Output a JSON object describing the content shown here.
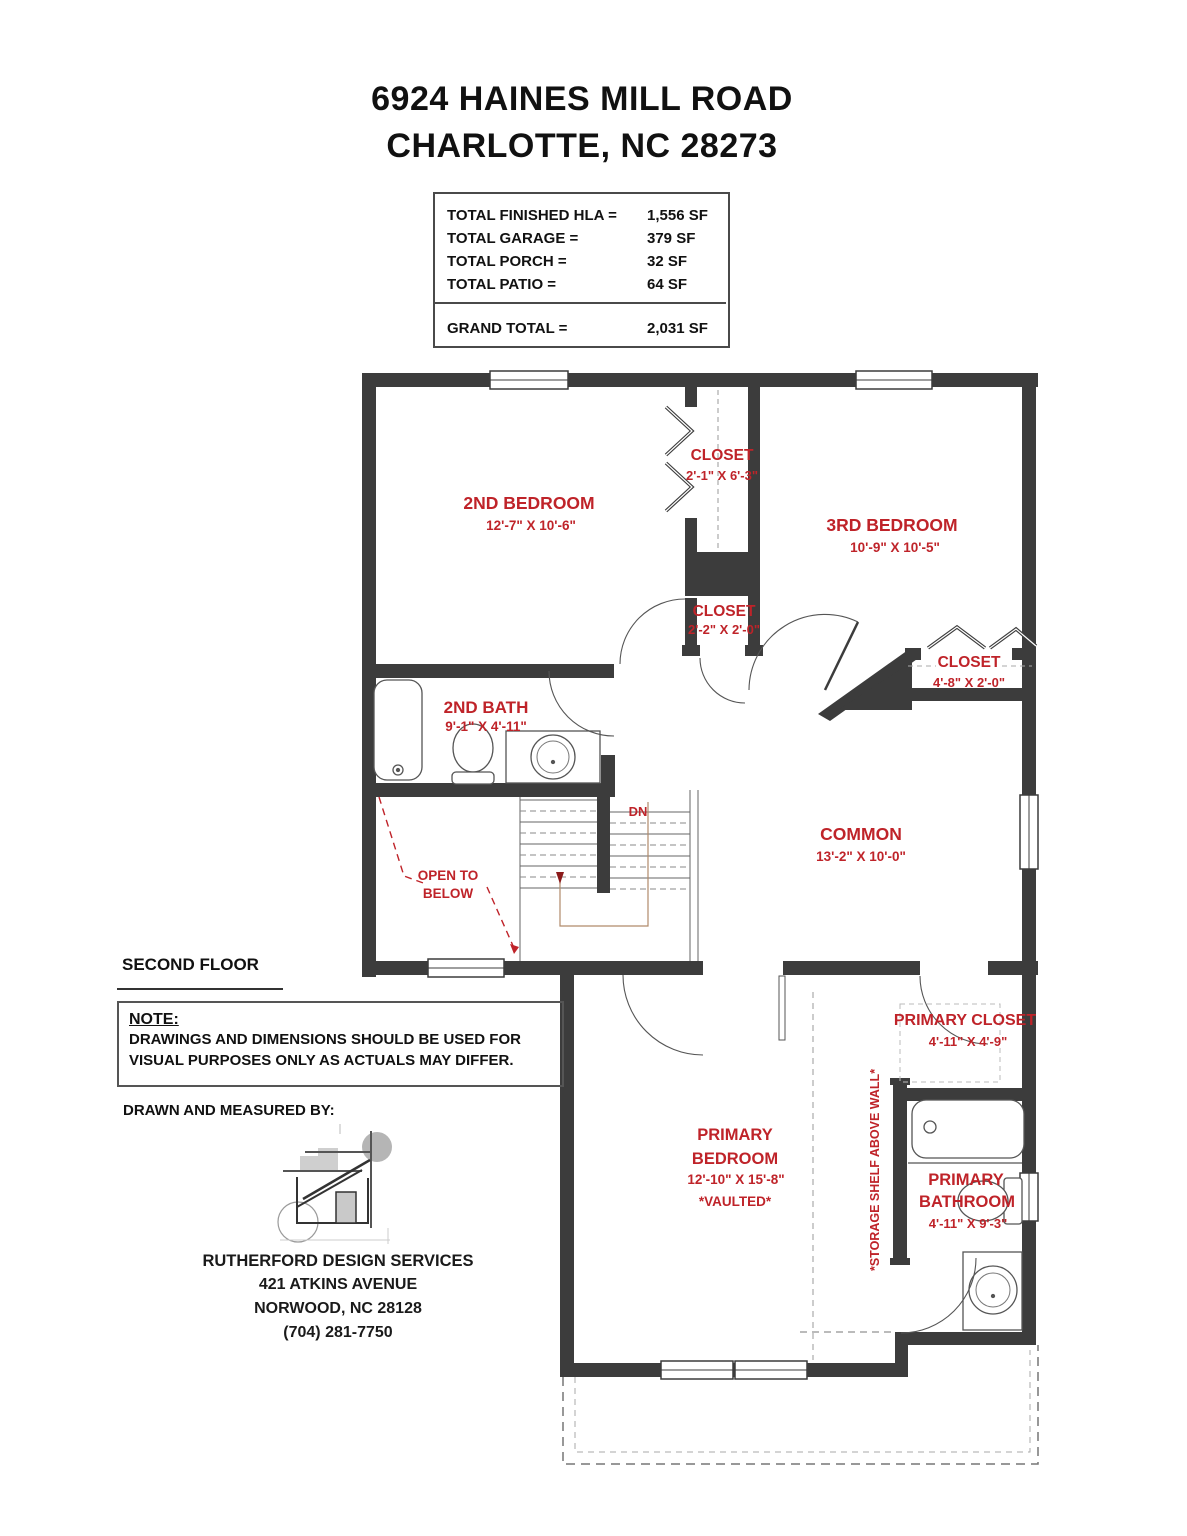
{
  "header": {
    "line1": "6924 HAINES MILL ROAD",
    "line2": "CHARLOTTE, NC 28273"
  },
  "area_table": {
    "rows": [
      {
        "label": "TOTAL FINISHED HLA =",
        "value": "1,556 SF"
      },
      {
        "label": "TOTAL GARAGE =",
        "value": "379 SF"
      },
      {
        "label": "TOTAL PORCH =",
        "value": "32 SF"
      },
      {
        "label": "TOTAL PATIO =",
        "value": "64 SF"
      }
    ],
    "grand_total": {
      "label": "GRAND TOTAL =",
      "value": "2,031 SF"
    }
  },
  "rooms": {
    "bedroom2": {
      "name": "2ND BEDROOM",
      "dims": "12'-7\" X 10'-6\""
    },
    "closet1": {
      "name": "CLOSET",
      "dims": "2'-1\" X 6'-3\""
    },
    "bedroom3": {
      "name": "3RD BEDROOM",
      "dims": "10'-9\" X 10'-5\""
    },
    "closet2": {
      "name": "CLOSET",
      "dims": "2'-2\" X 2'-0\""
    },
    "closet3": {
      "name": "CLOSET",
      "dims": "4'-8\" X 2'-0\""
    },
    "bath2": {
      "name": "2ND BATH",
      "dims": "9'-1\" X 4'-11\""
    },
    "common": {
      "name": "COMMON",
      "dims": "13'-2\" X 10'-0\""
    },
    "open_below_1": "OPEN TO",
    "open_below_2": "BELOW",
    "dn": "DN",
    "primary_closet": {
      "name": "PRIMARY CLOSET",
      "dims": "4'-11\" X 4'-9\""
    },
    "primary_bedroom": {
      "name1": "PRIMARY",
      "name2": "BEDROOM",
      "dims": "12'-10\" X 15'-8\"",
      "note": "*VAULTED*"
    },
    "primary_bathroom": {
      "name1": "PRIMARY",
      "name2": "BATHROOM",
      "dims": "4'-11\" X 9'-3\""
    },
    "storage_note": "*STORAGE SHELF ABOVE WALL*"
  },
  "footer": {
    "floor_label": "SECOND FLOOR",
    "note_title": "NOTE:",
    "note_line1": "DRAWINGS AND DIMENSIONS SHOULD BE USED FOR",
    "note_line2": "VISUAL PURPOSES ONLY AS ACTUALS MAY DIFFER.",
    "drawn_by": "DRAWN AND MEASURED BY:",
    "company_name": "RUTHERFORD DESIGN SERVICES",
    "company_address1": "421 ATKINS AVENUE",
    "company_address2": "NORWOOD, NC 28128",
    "company_phone": "(704) 281-7750"
  },
  "colors": {
    "label_red": "#bf2329",
    "wall": "#3c3c3c"
  }
}
